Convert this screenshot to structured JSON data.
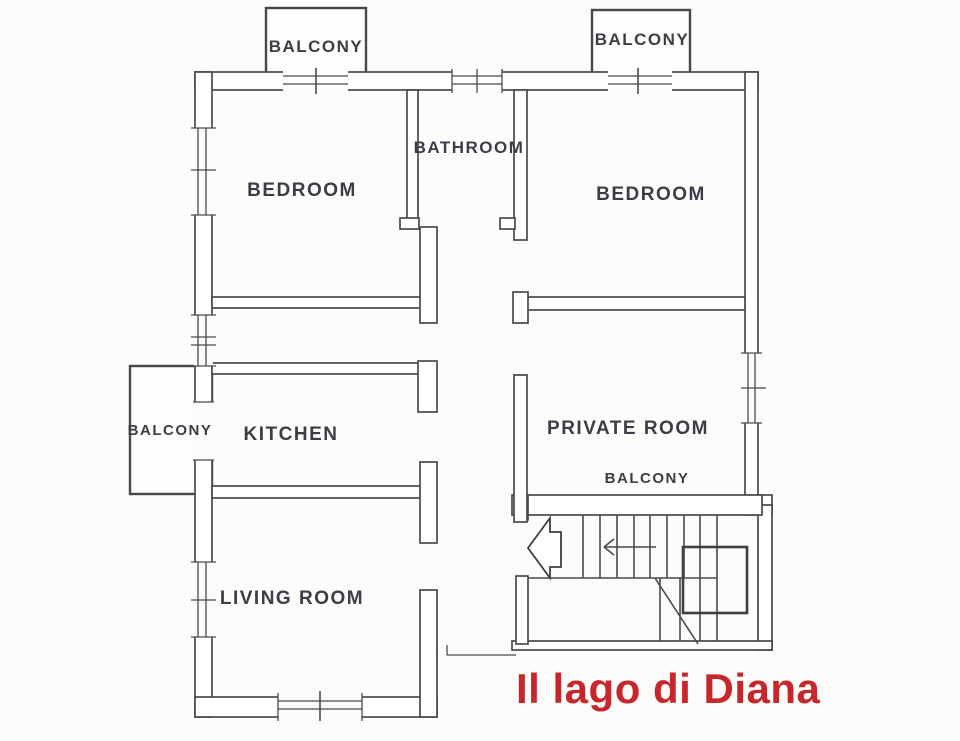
{
  "title": {
    "text": "Il lago di Diana",
    "color": "#c7262d"
  },
  "rooms": {
    "balcony_top_left": {
      "label": "BALCONY"
    },
    "balcony_top_right": {
      "label": "BALCONY"
    },
    "bedroom_left": {
      "label": "BEDROOM"
    },
    "bedroom_right": {
      "label": "BEDROOM"
    },
    "bathroom": {
      "label": "BATHROOM"
    },
    "kitchen": {
      "label": "KITCHEN"
    },
    "balcony_left": {
      "label": "BALCONY"
    },
    "private_room": {
      "label": "PRIVATE ROOM"
    },
    "private_room_balcony": {
      "label": "BALCONY"
    },
    "living_room": {
      "label": "LIVING ROOM"
    }
  },
  "colors": {
    "wall_line": "#4a4a4a",
    "label_text": "#3b3e47",
    "title_red": "#c7262d",
    "background": "#fcfcfb"
  }
}
